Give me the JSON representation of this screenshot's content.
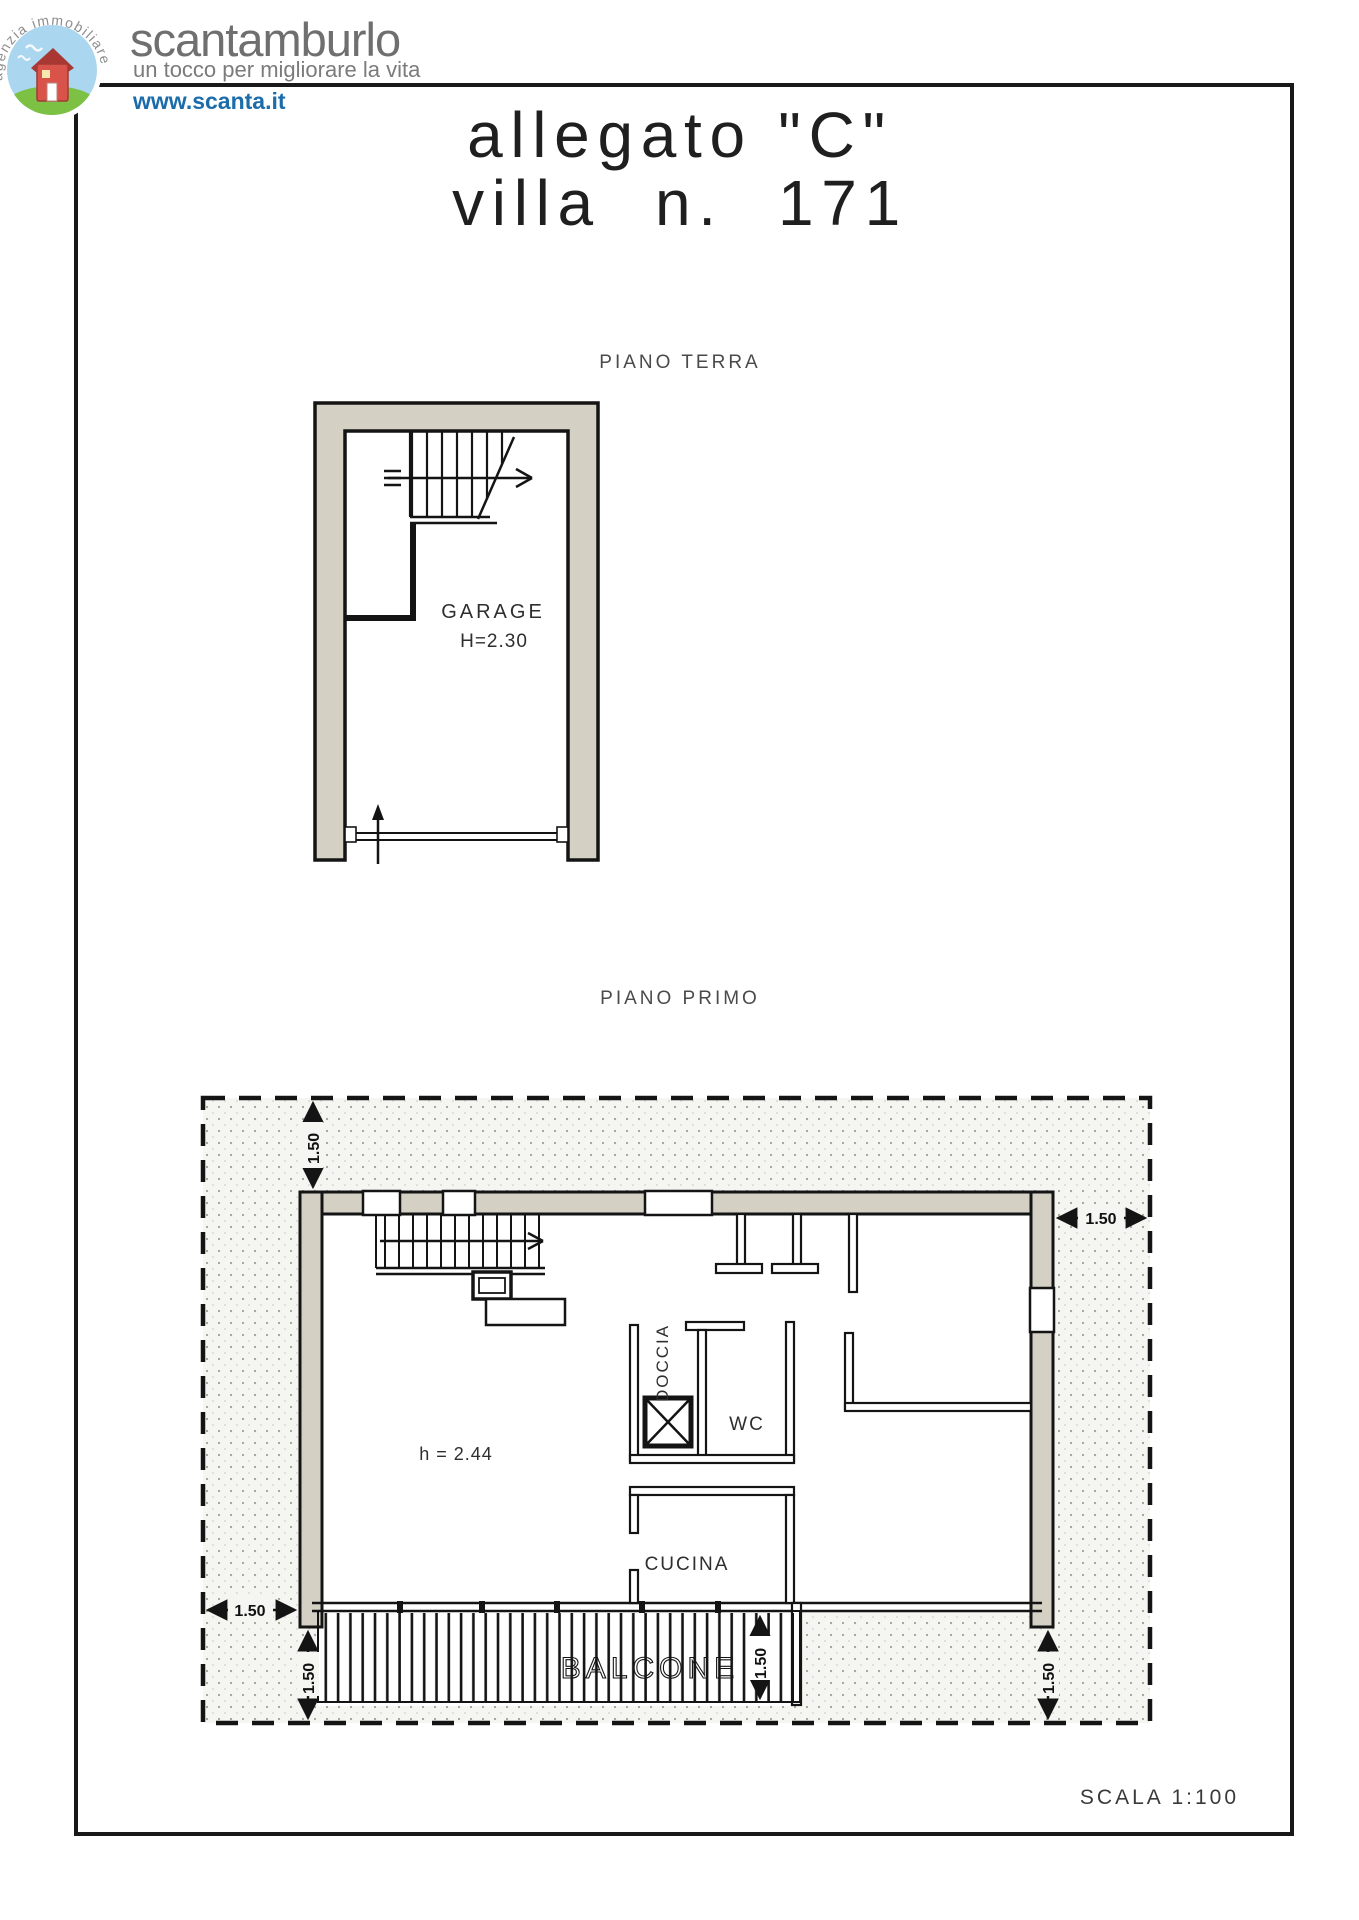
{
  "header": {
    "brand": "scantamburlo",
    "tagline": "un tocco per migliorare la vita",
    "website": "www.scanta.it",
    "logo_arc_text": "agenzia immobiliare",
    "colors": {
      "brand_text": "#6f6f6f",
      "website_text": "#1b6cab",
      "rule_line": "#191919"
    }
  },
  "document": {
    "title_line1": "allegato \"C\"",
    "title_line2": "villa n. 171",
    "scale_note": "SCALA 1:100"
  },
  "ground_floor_plan": {
    "label": "PIANO TERRA",
    "room_label": "GARAGE",
    "room_height": "H=2.30"
  },
  "first_floor_plan": {
    "label": "PIANO PRIMO",
    "room_labels": {
      "shower": "DOCCIA",
      "wc": "WC",
      "kitchen": "CUCINA",
      "balcony": "BALCONE"
    },
    "ceiling_height": "h = 2.44",
    "overhang_dim": "1.50"
  },
  "colors": {
    "wall_fill": "#d4d0c4",
    "line": "#141414",
    "stipple_dot": "#9aa391",
    "paper": "#ffffff"
  }
}
